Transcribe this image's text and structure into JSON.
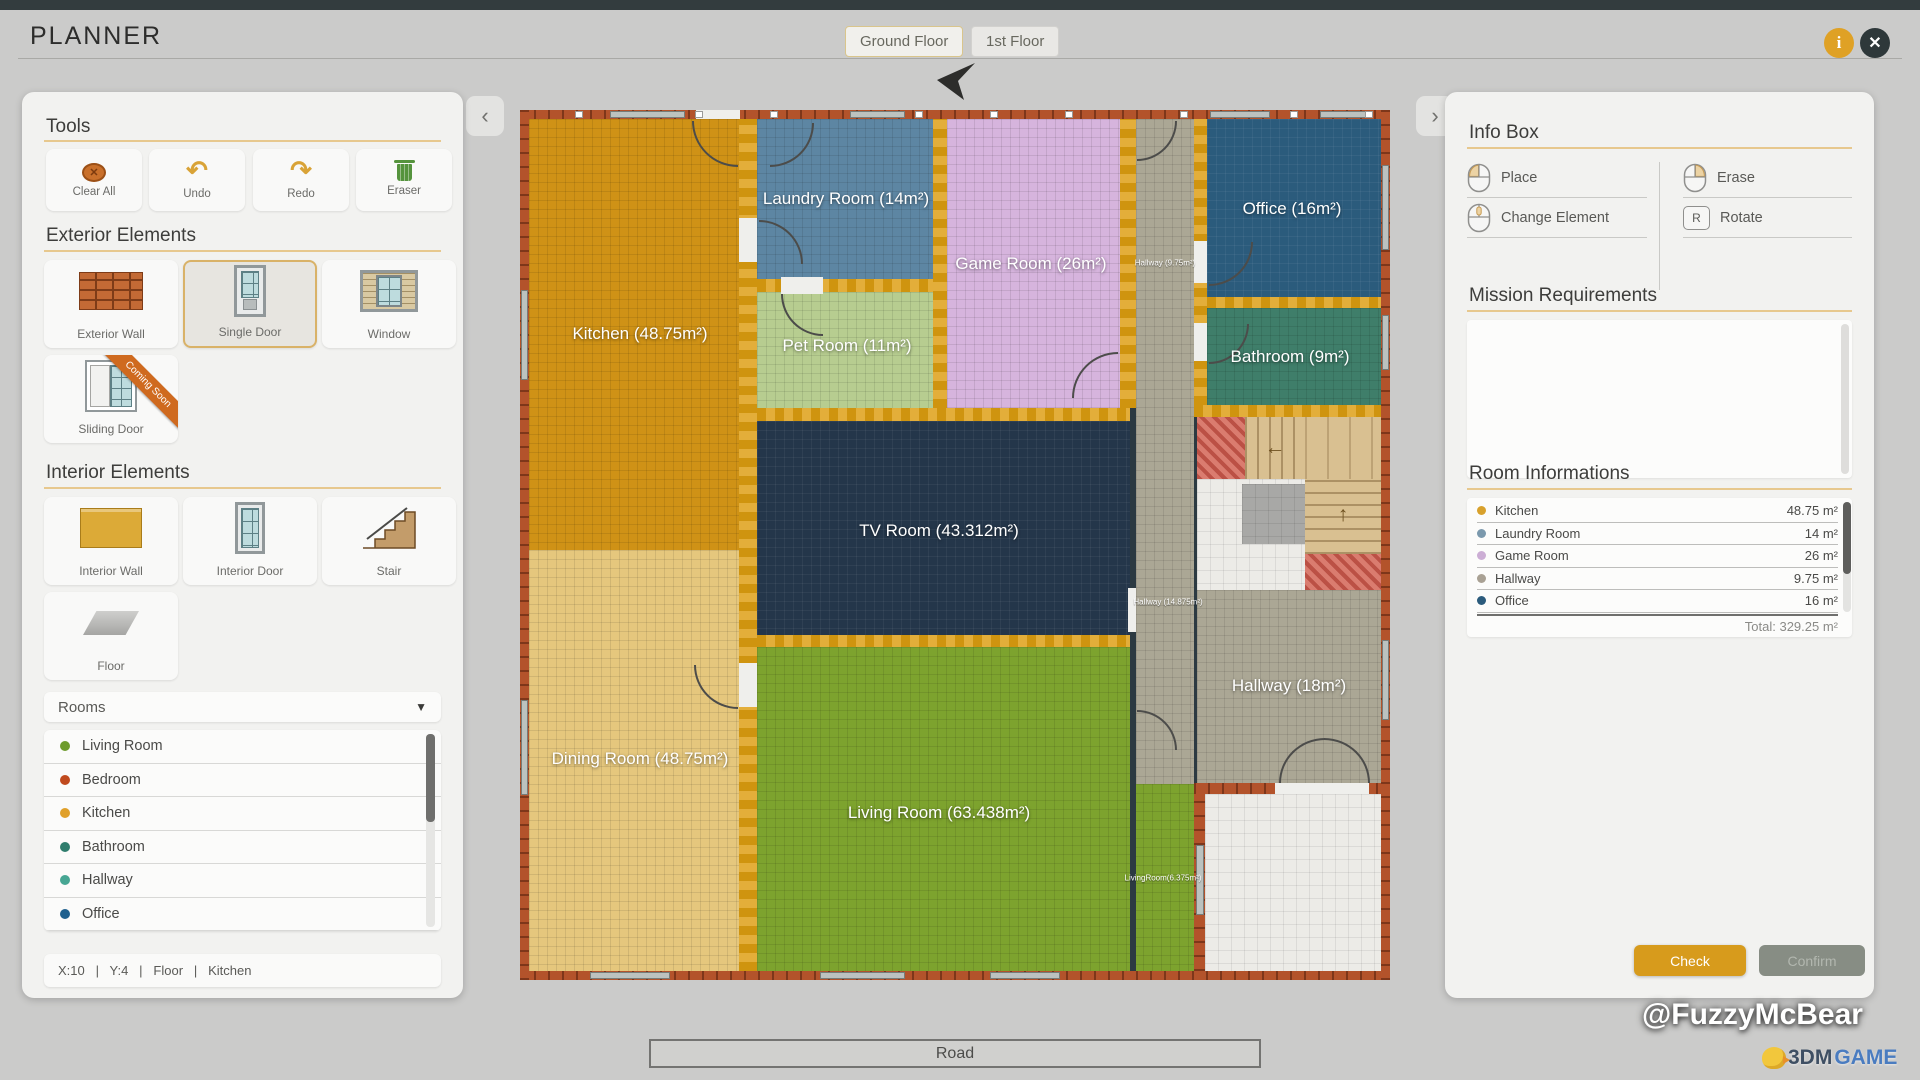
{
  "header": {
    "title": "PLANNER",
    "tabs": [
      {
        "label": "Ground Floor"
      },
      {
        "label": "1st Floor"
      }
    ],
    "icons": {
      "info": "info-icon",
      "close": "close-icon"
    },
    "info_glyph": "i",
    "close_glyph": "✕"
  },
  "left_panel": {
    "tools": {
      "heading": "Tools",
      "buttons": [
        {
          "label": "Clear All",
          "icon": "clear-all-icon",
          "glyph": "✕"
        },
        {
          "label": "Undo",
          "icon": "undo-icon"
        },
        {
          "label": "Redo",
          "icon": "redo-icon"
        },
        {
          "label": "Eraser",
          "icon": "eraser-trash-icon"
        }
      ]
    },
    "exterior": {
      "heading": "Exterior Elements",
      "items": [
        {
          "label": "Exterior Wall",
          "icon": "exterior-wall-icon"
        },
        {
          "label": "Single Door",
          "icon": "single-door-icon",
          "selected": true
        },
        {
          "label": "Window",
          "icon": "window-icon"
        },
        {
          "label": "Sliding Door",
          "icon": "sliding-door-icon",
          "badge": "Coming Soon"
        }
      ]
    },
    "interior": {
      "heading": "Interior Elements",
      "items": [
        {
          "label": "Interior Wall",
          "icon": "interior-wall-icon"
        },
        {
          "label": "Interior Door",
          "icon": "interior-door-icon"
        },
        {
          "label": "Stair",
          "icon": "stair-icon"
        },
        {
          "label": "Floor",
          "icon": "floor-icon"
        }
      ]
    },
    "rooms_dropdown": {
      "label": "Rooms",
      "arrow": "▼"
    },
    "room_list": [
      {
        "name": "Living Room",
        "color": "#6d9b2c"
      },
      {
        "name": "Bedroom",
        "color": "#c04a1e"
      },
      {
        "name": "Kitchen",
        "color": "#e0a02a"
      },
      {
        "name": "Bathroom",
        "color": "#2f7d6d"
      },
      {
        "name": "Hallway",
        "color": "#47a693"
      },
      {
        "name": "Office",
        "color": "#1f608e"
      }
    ],
    "status_bar": "X:10   |   Y:4   |   Floor   |   Kitchen"
  },
  "canvas": {
    "compass": "north-arrow",
    "road_label": "Road",
    "rooms": {
      "kitchen": {
        "label": "Kitchen (48.75m²)",
        "color": "#cf9216"
      },
      "dining": {
        "label": "Dining Room (48.75m²)",
        "color": "#e5c77d"
      },
      "laundry": {
        "label": "Laundry Room (14m²)",
        "color": "#5d86a3"
      },
      "pet": {
        "label": "Pet Room (11m²)",
        "color": "#b7cd90"
      },
      "game": {
        "label": "Game Room (26m²)",
        "color": "#d6b4dd"
      },
      "tv": {
        "label": "TV Room (43.312m²)",
        "color": "#24364a"
      },
      "living": {
        "label": "Living Room (63.438m²)",
        "color": "#7da32e"
      },
      "living_small": {
        "label": "LivingRoom(6.375m²)"
      },
      "hallway_top": {
        "label": "Hallway (9.75m²)",
        "color": "#aba795"
      },
      "hallway_mid": {
        "label": "Hallway (14.875m²)"
      },
      "hallway_big": {
        "label": "Hallway (18m²)",
        "color": "#aba795"
      },
      "office": {
        "label": "Office (16m²)",
        "color": "#2b5b7c"
      },
      "bathroom": {
        "label": "Bathroom (9m²)",
        "color": "#3f7e6a"
      }
    }
  },
  "right_panel": {
    "info_box": {
      "heading": "Info Box",
      "actions": [
        {
          "label": "Place",
          "icon": "mouse-left-icon"
        },
        {
          "label": "Change Element",
          "icon": "mouse-middle-icon"
        },
        {
          "label": "Erase",
          "icon": "mouse-right-icon"
        },
        {
          "label": "Rotate",
          "icon": "key-r-icon",
          "key": "R"
        }
      ]
    },
    "mission": {
      "heading": "Mission Requirements"
    },
    "room_info": {
      "heading": "Room Informations",
      "rows": [
        {
          "name": "Kitchen",
          "area": "48.75 m²",
          "color": "#d8a12c"
        },
        {
          "name": "Laundry Room",
          "area": "14 m²",
          "color": "#7b99ad"
        },
        {
          "name": "Game Room",
          "area": "26 m²",
          "color": "#ccaed5"
        },
        {
          "name": "Hallway",
          "area": "9.75 m²",
          "color": "#a9a194"
        },
        {
          "name": "Office",
          "area": "16 m²",
          "color": "#2b5b7c"
        }
      ],
      "total": "Total: 329.25 m²"
    },
    "buttons": {
      "check": "Check",
      "confirm": "Confirm"
    }
  },
  "watermarks": {
    "credit": "@FuzzyMcBear",
    "logo_3dm": "3DM",
    "logo_game": "GAME"
  }
}
